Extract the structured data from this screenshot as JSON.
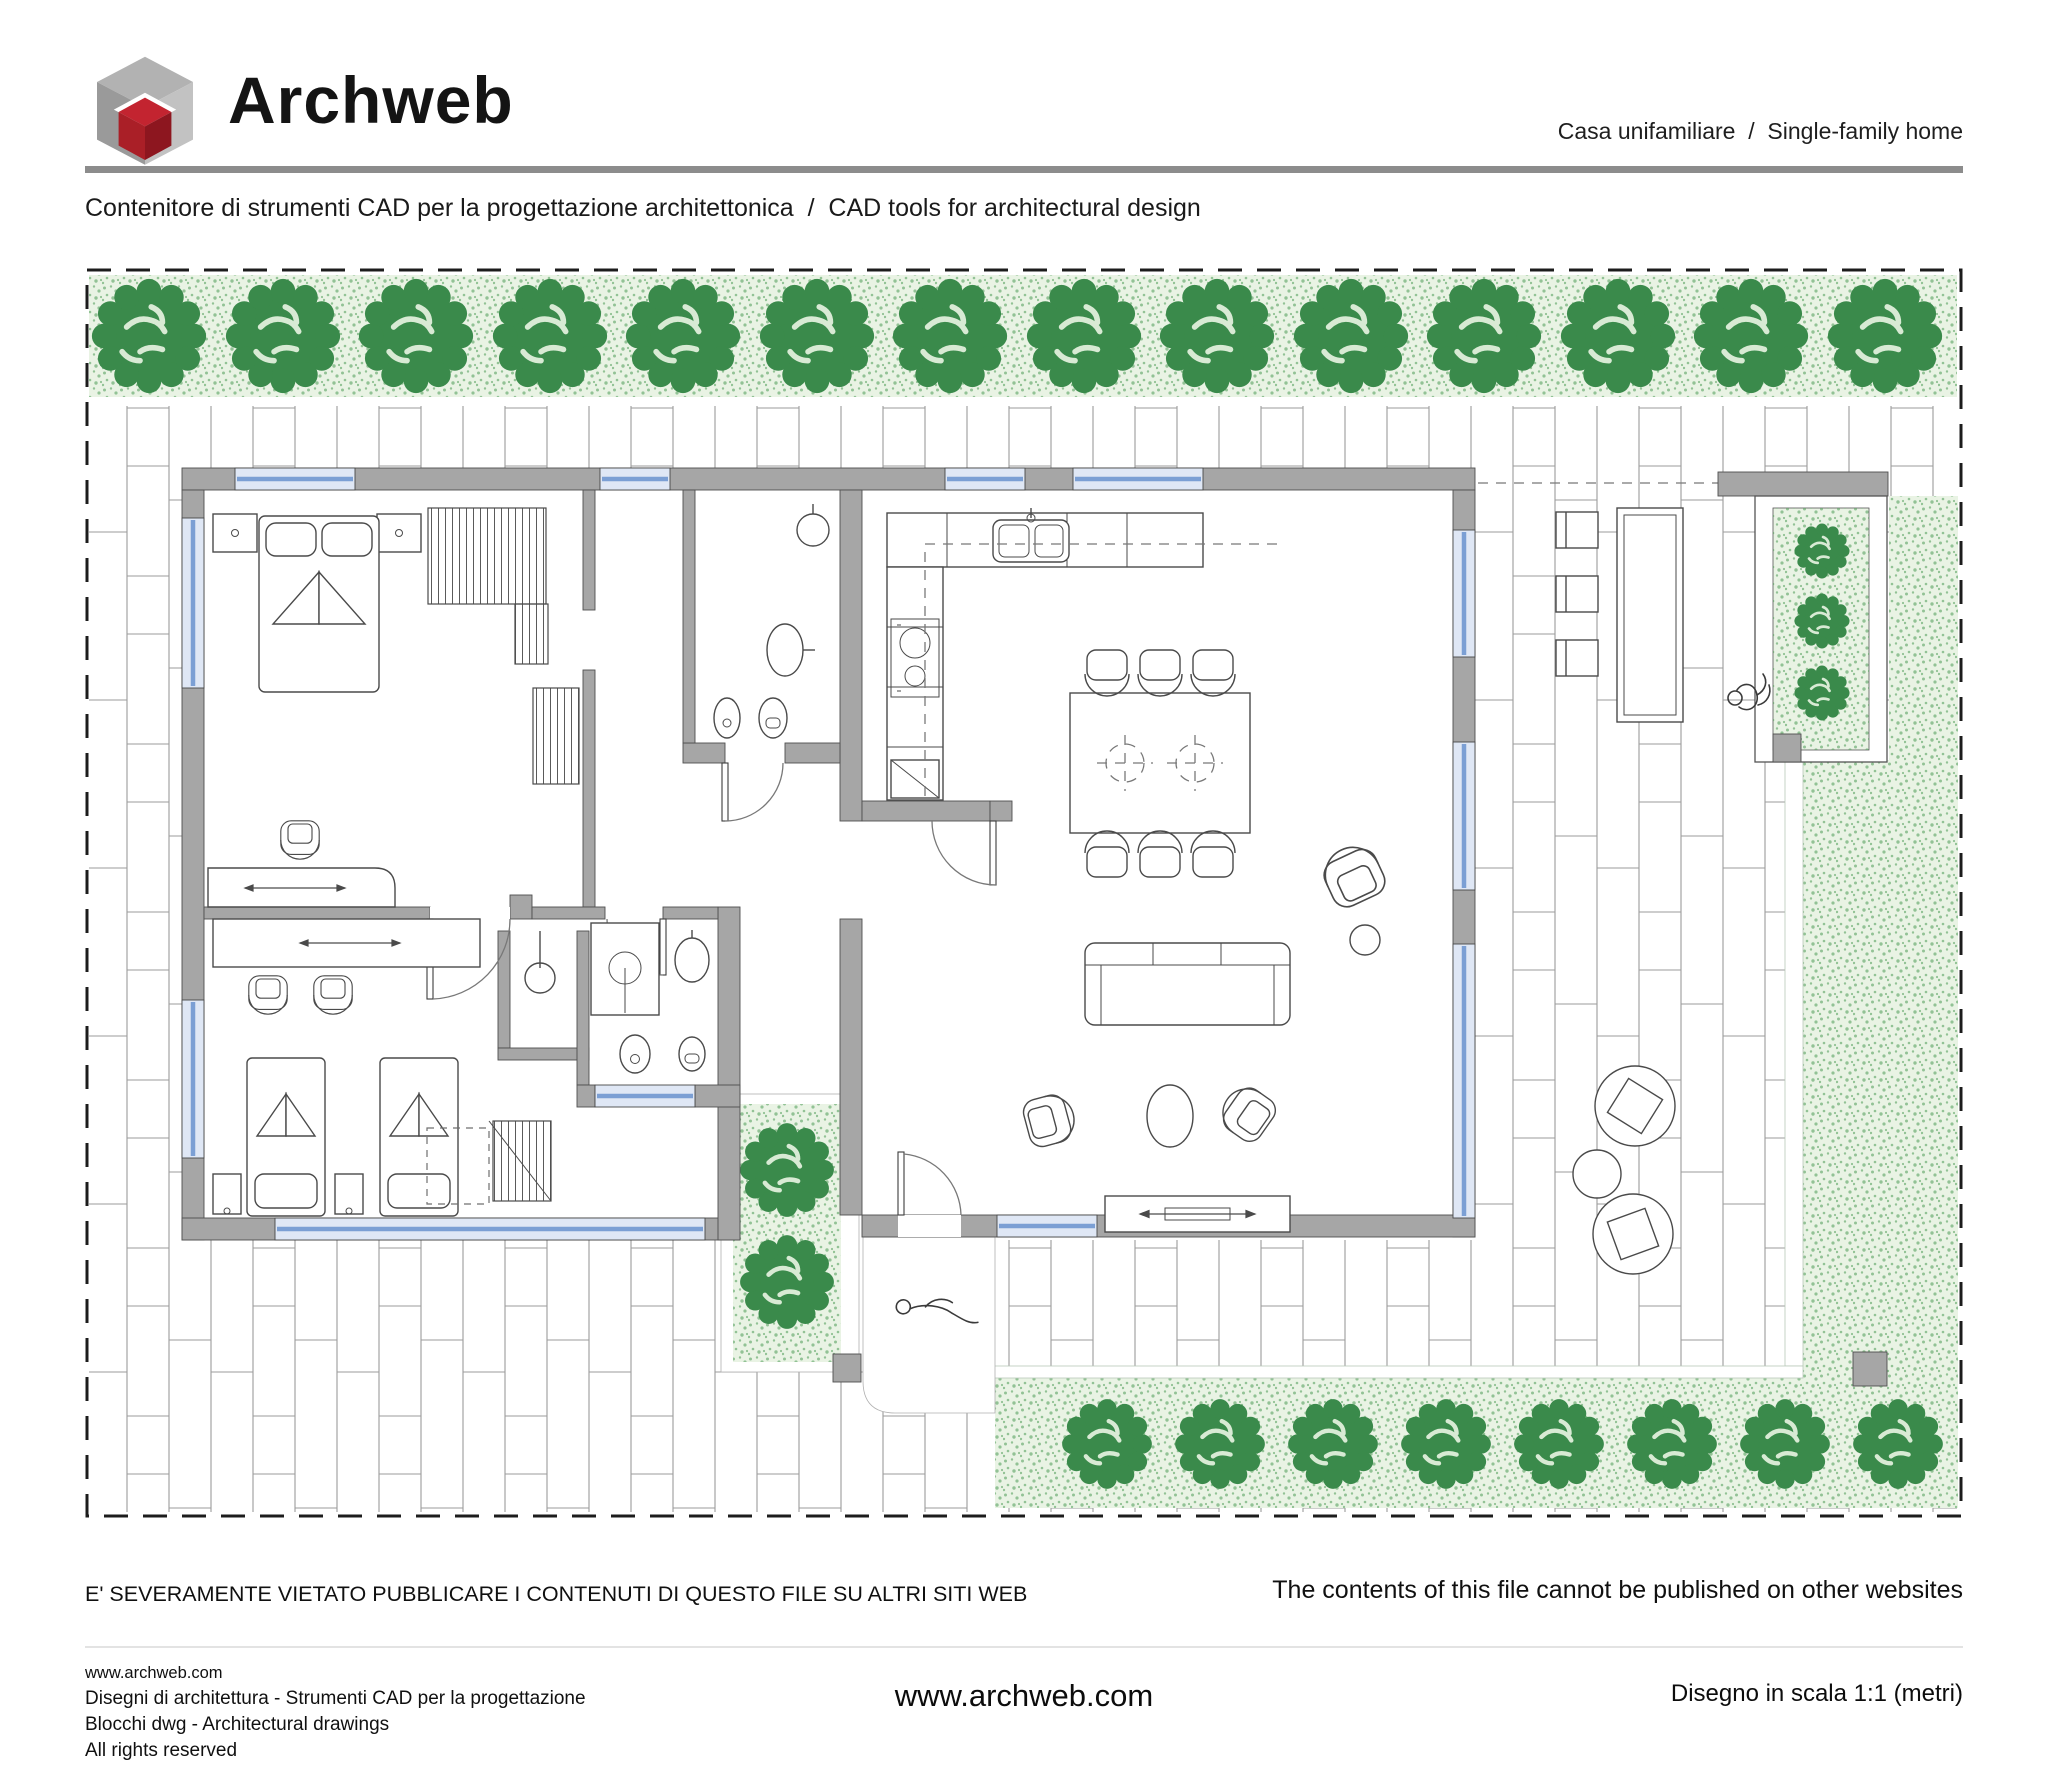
{
  "header": {
    "logo_text": "Archweb",
    "category": "Casa unifamiliare  /  Single-family home",
    "tagline": "Contenitore di strumenti CAD per la progettazione architettonica  /  CAD tools for architectural design"
  },
  "footer": {
    "warning_it": "E' SEVERAMENTE VIETATO PUBBLICARE I CONTENUTI DI QUESTO FILE SU ALTRI SITI WEB",
    "warning_en": "The contents of this file cannot be published on other websites",
    "site_line1": "www.archweb.com",
    "site_line2": "Disegni di architettura - Strumenti CAD  per la progettazione",
    "site_line3": "Blocchi dwg - Architectural drawings",
    "site_line4": "All rights reserved",
    "center_url": "www.archweb.com",
    "scale_note": "Disegno in scala 1:1 (metri)"
  },
  "colors": {
    "logo_red": "#aa1f27",
    "logo_gray": "#b2b2b2",
    "rule_gray": "#8c8c8c",
    "wall_gray": "#a6a6a6",
    "tree_green": "#3a8a4b",
    "lawn_green": "#e9f3e4",
    "stipple_green": "#5ba463",
    "window_blue": "#7b9fd4",
    "glass_blue": "#dfe7f5",
    "paving_line": "#9b9b9b",
    "line_ink": "#4a4a4a"
  }
}
